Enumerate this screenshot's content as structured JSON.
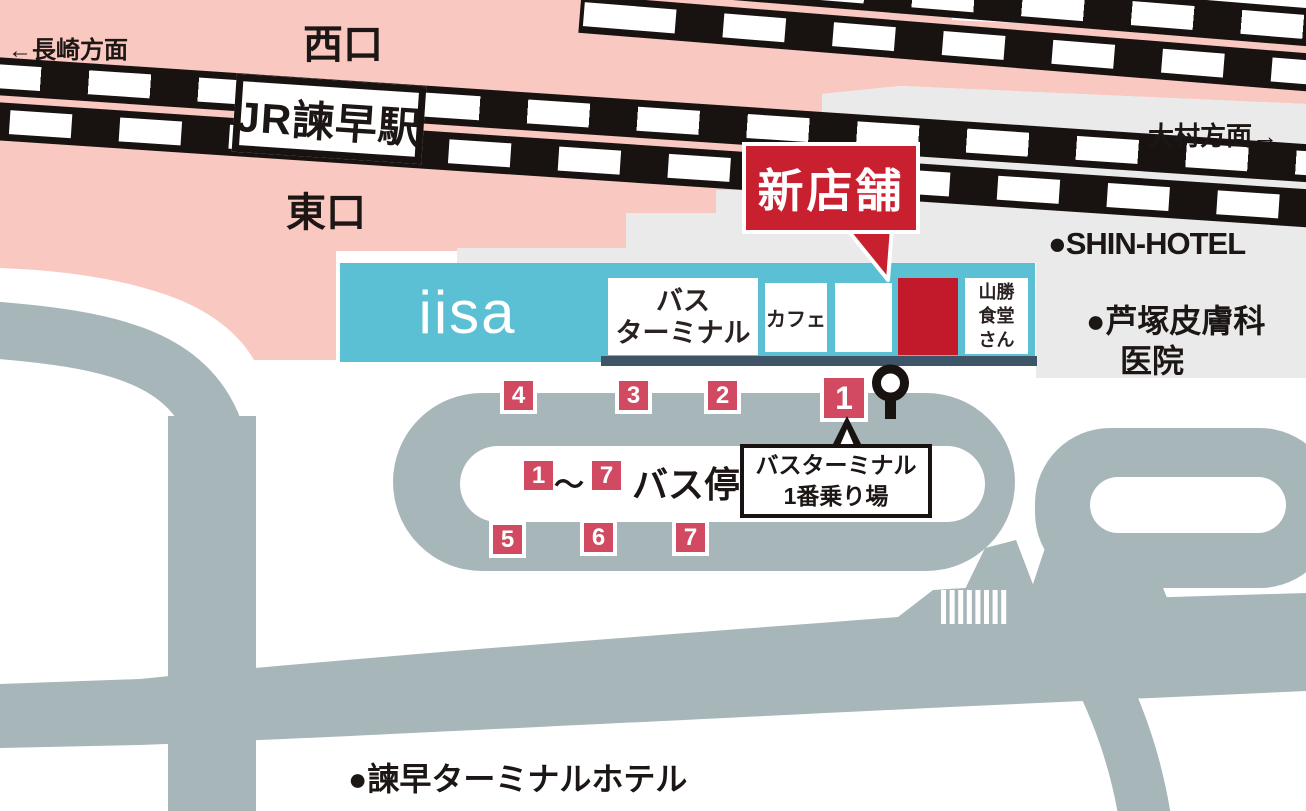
{
  "labels": {
    "nagasaki_direction": "←長崎方面",
    "omura_direction": "大村方面→",
    "west_exit": "西口",
    "east_exit": "東口",
    "station_sign": "JR諫早駅",
    "shin_hotel": "●SHIN-HOTEL",
    "ashizuka_clinic_line1": "●芦塚皮膚科",
    "ashizuka_clinic_line2": "医院",
    "terminal_hotel": "●諫早ターミナルホテル"
  },
  "station_building": {
    "iisa": "iisa",
    "bus_terminal_lines": [
      "バス",
      "ターミナル"
    ],
    "cafe": "カフェ",
    "yamakatsu_lines": [
      "山勝",
      "食堂",
      "さん"
    ]
  },
  "new_store_callout": "新店舗",
  "bus_stops": {
    "numbers": [
      "1",
      "2",
      "3",
      "4",
      "5",
      "6",
      "7"
    ],
    "legend": {
      "from": "1",
      "tilde": "～",
      "to": "7",
      "label": "バス停"
    },
    "platform_callout_lines": [
      "バスターミナル",
      "1番乗り場"
    ]
  },
  "colors": {
    "pink_station_area": "#f9c8c0",
    "gray_building_area": "#eaeaea",
    "road": "#a7b6b9",
    "terminal_building_teal": "#5bc0d4",
    "building_shadow": "#3d5566",
    "badge_red": "#d24a62",
    "new_store_red": "#c8202f",
    "rail_black": "#181210"
  }
}
